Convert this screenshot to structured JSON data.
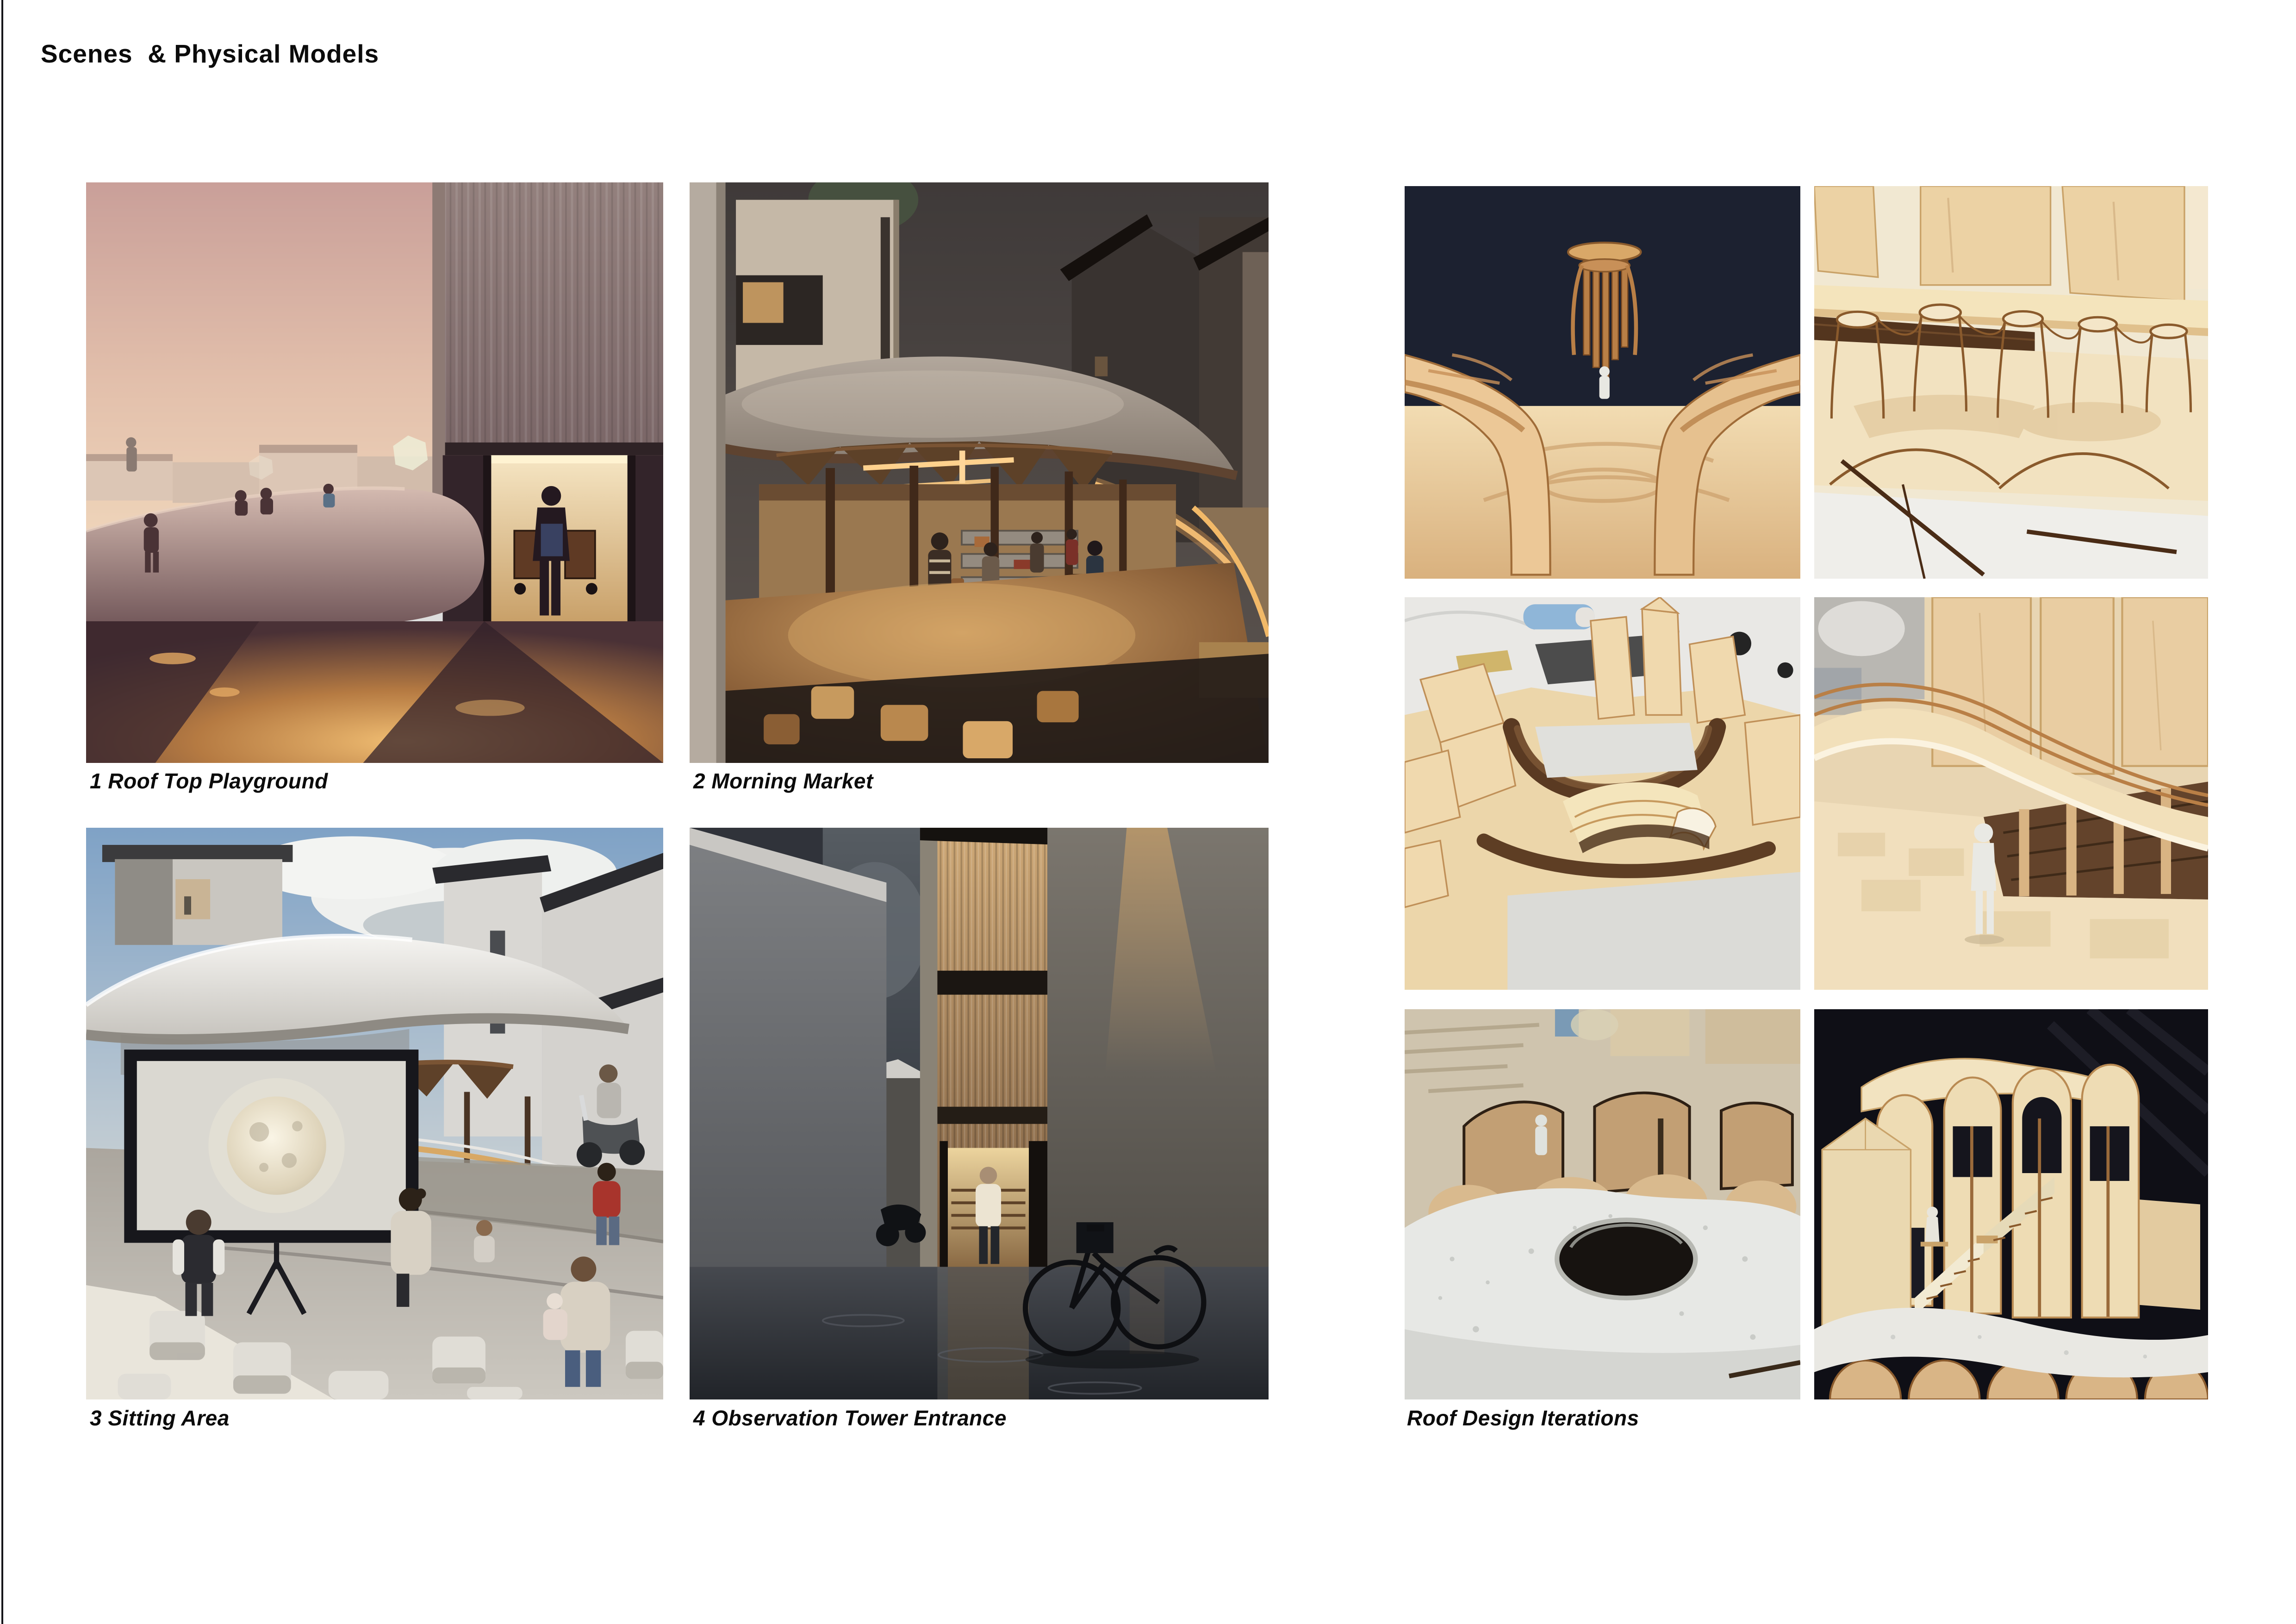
{
  "page": {
    "title": "Scenes  & Physical Models",
    "background": "#ffffff",
    "text_color": "#0b0b0b",
    "edge_line_color": "#15151a"
  },
  "scenes": [
    {
      "caption": "1 Roof Top Playground",
      "alt": "dusk rooftop playground render with curved concrete roof, children and man with cart at lit doorway"
    },
    {
      "caption": "2 Morning Market",
      "alt": "early-morning market render under a large curved canopy with warm strip lighting and shoppers"
    },
    {
      "caption": "3 Sitting Area",
      "alt": "daytime sitting area render with projection screen showing the moon, cube stools and seated people"
    },
    {
      "caption": "4 Observation Tower Entrance",
      "alt": "narrow rainy alley render with glowing corrugated tower entrance, bicycle and walking figure"
    }
  ],
  "models": {
    "caption": "Roof Design Iterations",
    "photos": [
      {
        "alt": "plywood colonnade model, eye-level view on dark background"
      },
      {
        "alt": "laser-cut skeletal column frames with wooden blocks"
      },
      {
        "alt": "top view of site massing model with walnut terraces"
      },
      {
        "alt": "close-up of curved canopy model with white figure"
      },
      {
        "alt": "plaster roof model with round oculus and white figure"
      },
      {
        "alt": "arched tower model with zigzag stair on black background"
      }
    ]
  }
}
